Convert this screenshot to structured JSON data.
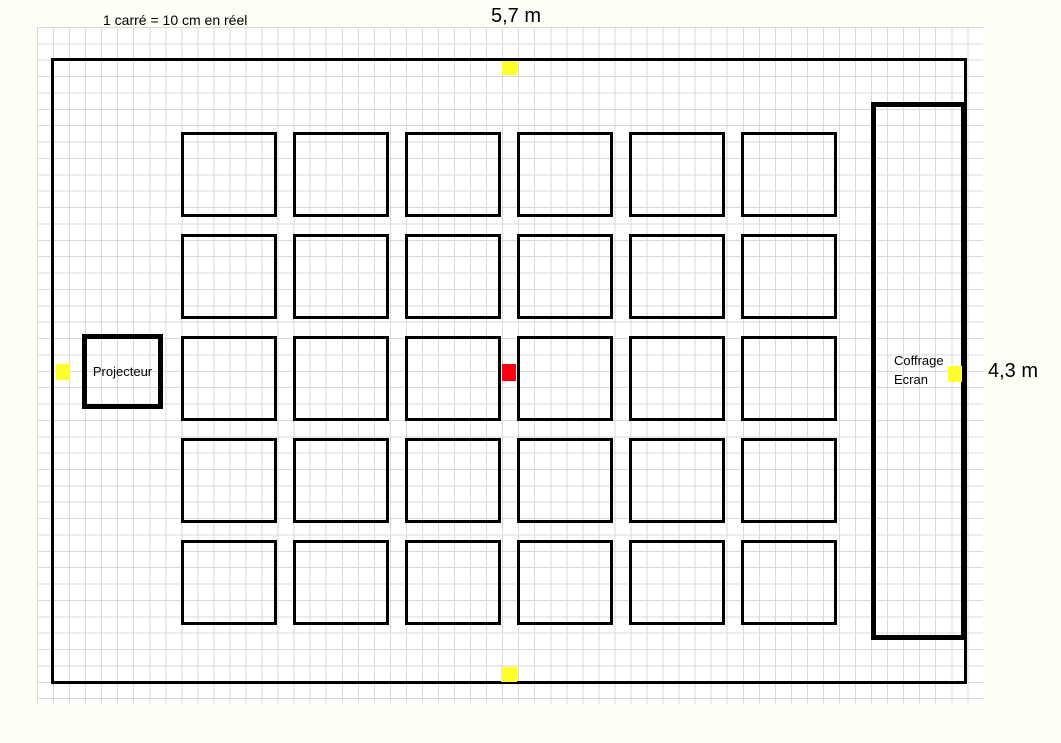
{
  "scale_note": "1 carré = 10 cm en réel",
  "dimensions": {
    "width": "5,7 m",
    "height": "4,3 m"
  },
  "fixtures": {
    "projector": "Projecteur",
    "screen_line1": "Coffrage",
    "screen_line2": "Ecran"
  },
  "layout_grid": {
    "desk_rows": 5,
    "desk_cols": 6
  },
  "markers": [
    {
      "name": "midpoint-marker-top",
      "color": "yellow"
    },
    {
      "name": "midpoint-marker-bottom",
      "color": "yellow"
    },
    {
      "name": "midpoint-marker-left",
      "color": "yellow"
    },
    {
      "name": "midpoint-marker-right",
      "color": "yellow"
    },
    {
      "name": "room-center-marker",
      "color": "red"
    }
  ],
  "colors": {
    "paper": "#fffef7",
    "gridline": "#d9d9d9",
    "wall": "#000000",
    "marker_yellow": "#ffff2e",
    "marker_red": "#fb0010"
  }
}
